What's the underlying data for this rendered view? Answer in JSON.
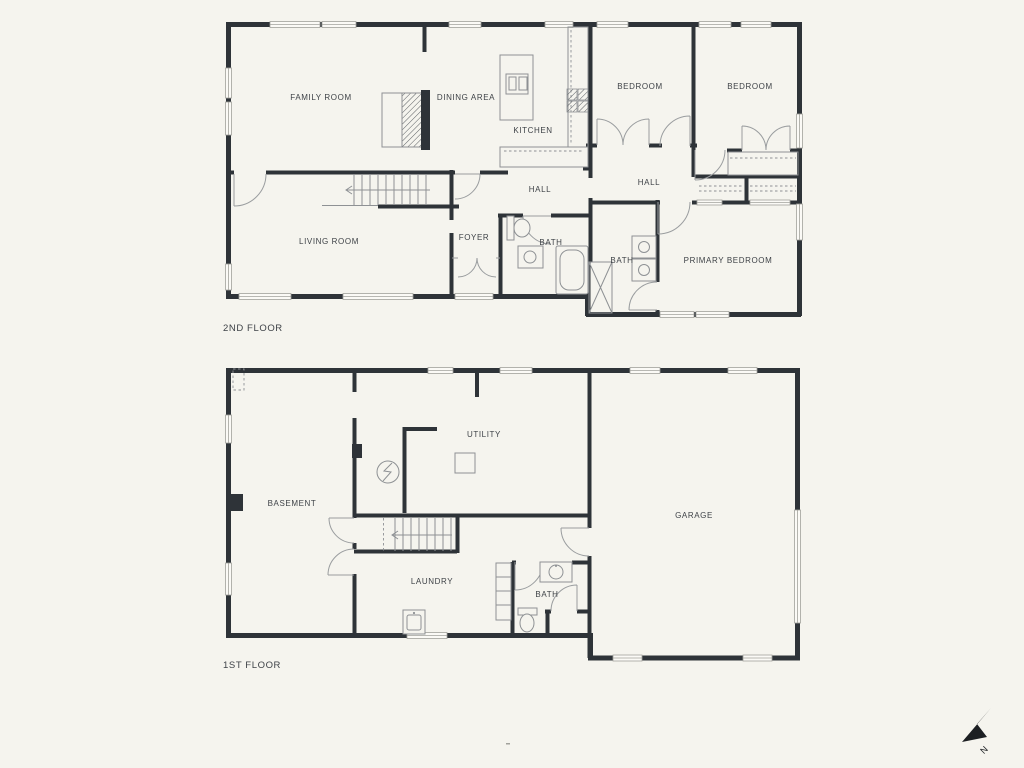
{
  "second": {
    "floor_label": "2ND FLOOR",
    "rooms": {
      "family_room": "FAMILY ROOM",
      "dining_area": "DINING AREA",
      "kitchen": "KITCHEN",
      "bedroom_left": "BEDROOM",
      "bedroom_right": "BEDROOM",
      "hall_left": "HALL",
      "hall_right": "HALL",
      "living_room": "LIVING ROOM",
      "foyer": "FOYER",
      "bath_left": "BATH",
      "bath_right": "BATH",
      "primary_bedroom": "PRIMARY BEDROOM"
    }
  },
  "first": {
    "floor_label": "1ST FLOOR",
    "rooms": {
      "basement": "BASEMENT",
      "utility": "UTILITY",
      "garage": "GARAGE",
      "laundry": "LAUNDRY",
      "bath": "BATH"
    }
  },
  "compass": {
    "label": "N"
  },
  "colors": {
    "background": "#f5f4ee",
    "wall": "#2e3338",
    "thin_line": "#8e9194",
    "window_fill": "#fbfaf6",
    "text": "#3e4247"
  }
}
